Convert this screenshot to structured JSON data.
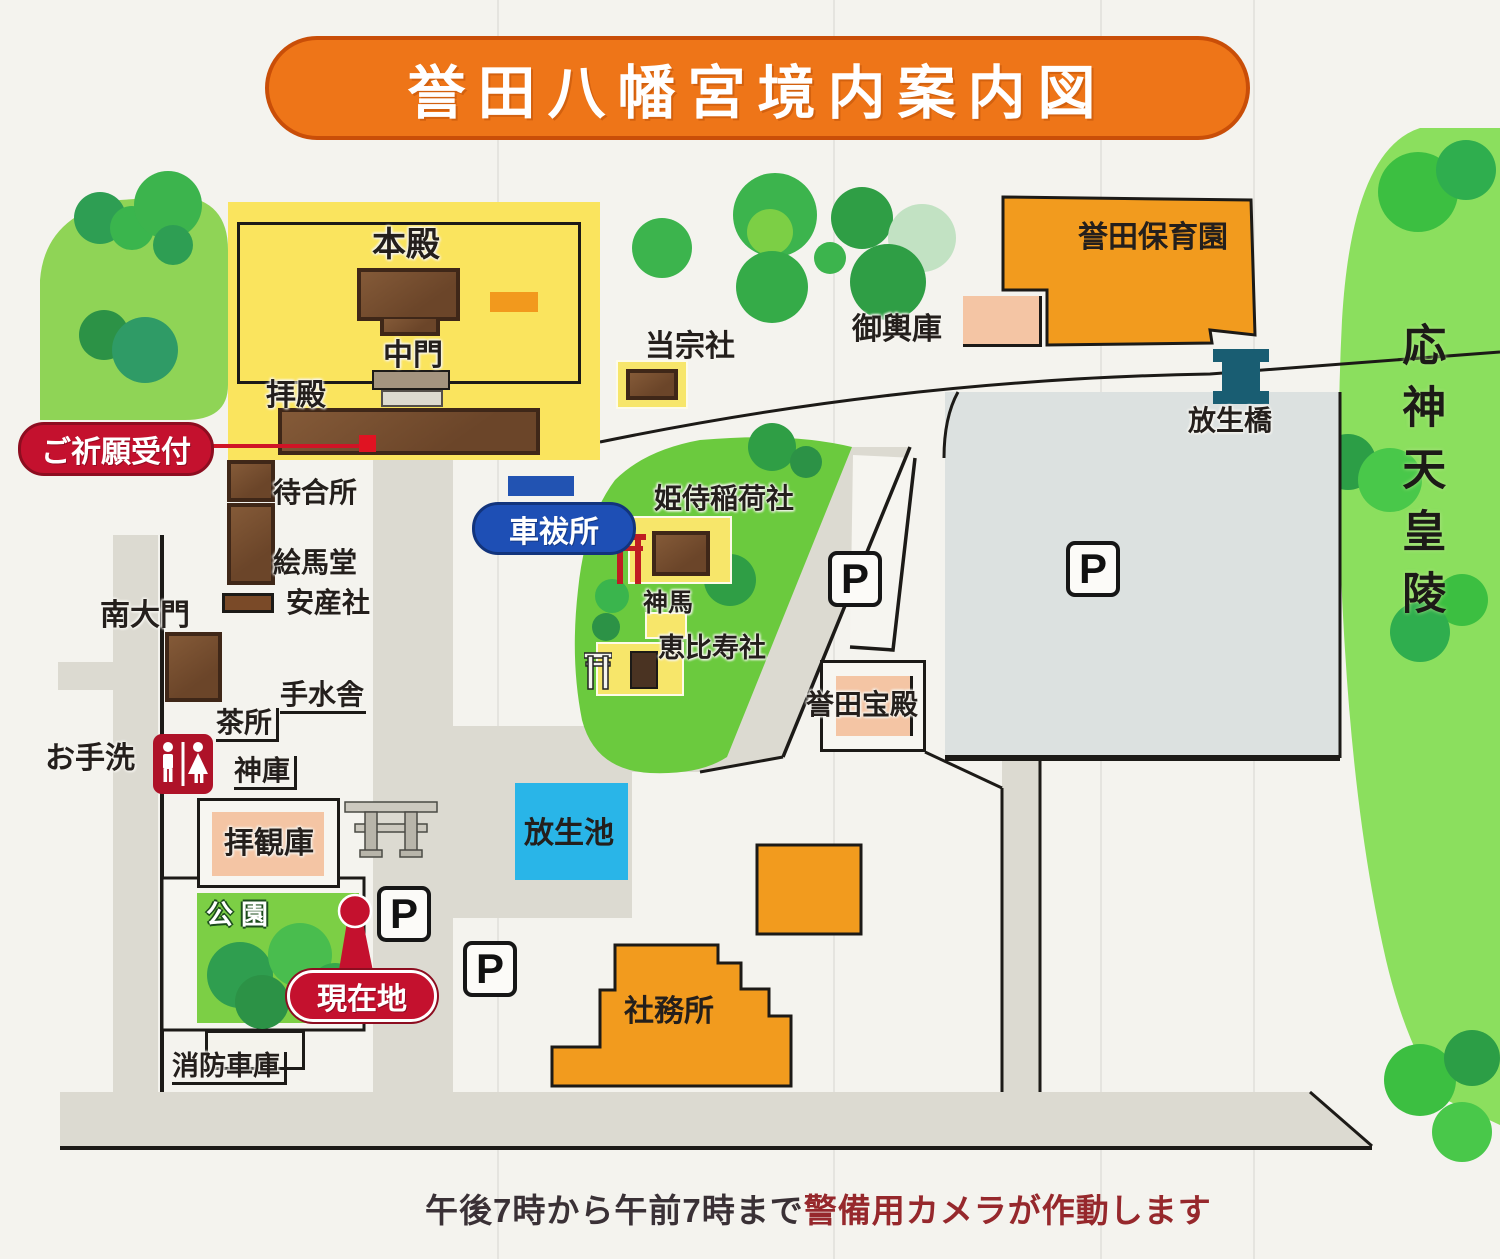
{
  "title": "誉田八幡宮境内案内図",
  "notice": {
    "time_part": "午後7時から午前7時まで",
    "camera_part": "警備用カメラが作動します"
  },
  "badges": {
    "prayer_reception": "ご祈願受付",
    "car_purification": "車祓所",
    "current_location": "現在地"
  },
  "buildings": {
    "honden": "本殿",
    "chumon": "中門",
    "haiden": "拝殿",
    "machiaisho": "待合所",
    "emado": "絵馬堂",
    "anzansha": "安産社",
    "nandaimon": "南大門",
    "temizusha": "手水舎",
    "chadokoro": "茶所",
    "shinko": "神庫",
    "haikanko": "拝観庫",
    "shobo_shako": "消防車庫",
    "tosousha": "当宗社",
    "himemachi_inarisha": "姫侍稲荷社",
    "shinme": "神馬",
    "ebisusha": "恵比寿社",
    "mikoshiko": "御輿庫",
    "konda_hoikuen": "誉田保育園",
    "konda_hoden": "誉田宝殿",
    "shamusho": "社務所"
  },
  "places": {
    "otearai": "お手洗",
    "koen": "公園",
    "hojobashi": "放生橋",
    "hojoike": "放生池",
    "ojin_tenno_ryo": "応神天皇陵"
  },
  "markers": {
    "parking": "P"
  },
  "colors": {
    "banner_orange": "#ee7518",
    "badge_red": "#c4112e",
    "badge_blue": "#1e4fb5",
    "pond_blue": "#29b5e8",
    "precinct_yellow": "#fae45e",
    "building_brown": "#6f4a2f",
    "orange_building": "#f29b1e",
    "salmon_building": "#f4c5a4",
    "road_gray": "#dcdad1",
    "parking_gray": "#dce1e0",
    "hill_green": "#6bca3e",
    "tomb_green": "#8bdf5e",
    "bridge_teal": "#195d72"
  }
}
